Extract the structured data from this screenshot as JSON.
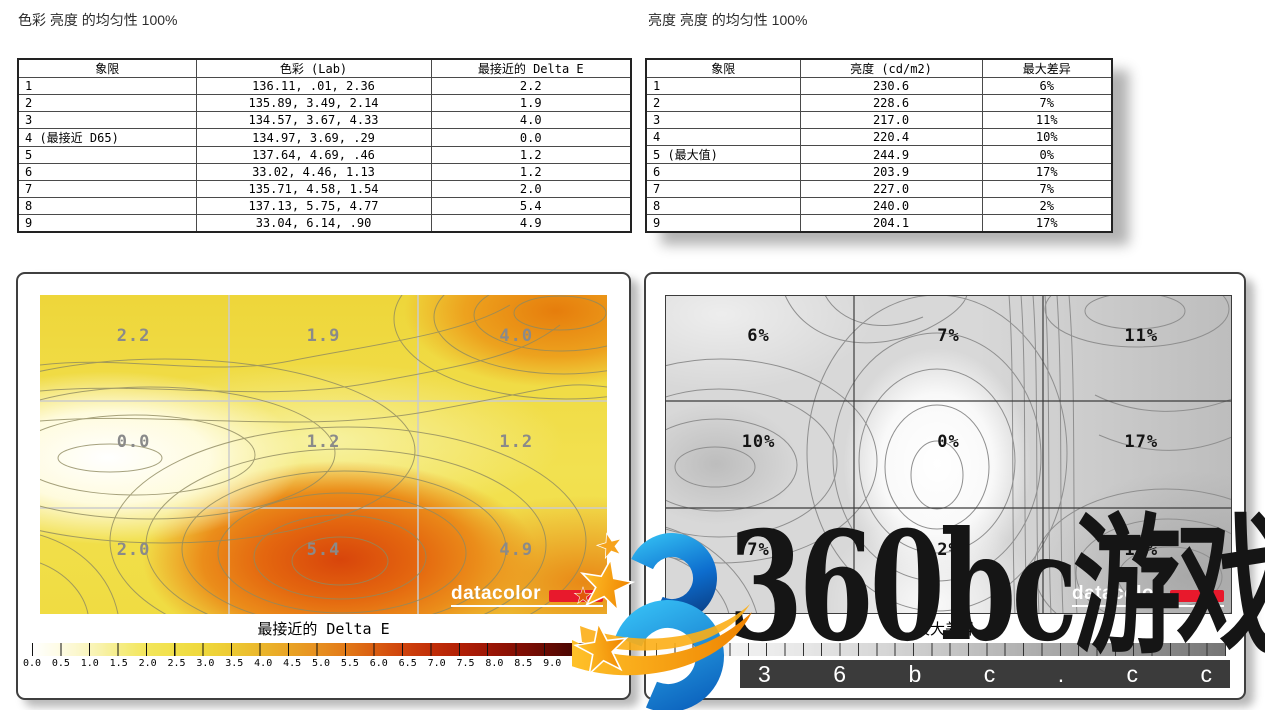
{
  "left_report": {
    "title": "色彩 亮度 的均匀性 100%",
    "table": {
      "headers": [
        "象限",
        "色彩 (Lab)",
        "最接近的 Delta E"
      ],
      "rows": [
        {
          "q": "1",
          "lab": "136.11,    .01,   2.36",
          "de": "2.2"
        },
        {
          "q": "2",
          "lab": "135.89,   3.49,   2.14",
          "de": "1.9"
        },
        {
          "q": "3",
          "lab": "134.57,   3.67,   4.33",
          "de": "4.0"
        },
        {
          "q": "4 (最接近 D65)",
          "lab": "134.97,   3.69,    .29",
          "de": "0.0"
        },
        {
          "q": "5",
          "lab": "137.64,   4.69,    .46",
          "de": "1.2"
        },
        {
          "q": "6",
          "lab": " 33.02,   4.46,   1.13",
          "de": "1.2"
        },
        {
          "q": "7",
          "lab": "135.71,   4.58,   1.54",
          "de": "2.0"
        },
        {
          "q": "8",
          "lab": "137.13,   5.75,   4.77",
          "de": "5.4"
        },
        {
          "q": "9",
          "lab": " 33.04,   6.14,    .90",
          "de": "4.9"
        }
      ]
    },
    "map": {
      "cells": [
        "2.2",
        "1.9",
        "4.0",
        "0.0",
        "1.2",
        "1.2",
        "2.0",
        "5.4",
        "4.9"
      ],
      "caption": "最接近的 Delta E",
      "ticks": [
        "0.0",
        "0.5",
        "1.0",
        "1.5",
        "2.0",
        "2.5",
        "3.0",
        "3.5",
        "4.0",
        "4.5",
        "5.0",
        "5.5",
        "6.0",
        "6.5",
        "7.0",
        "7.5",
        "8.0",
        "8.5",
        "9.0",
        "9.5",
        "10.0"
      ],
      "logo_text": "datacolor"
    }
  },
  "right_report": {
    "title": "亮度 亮度 的均匀性 100%",
    "table": {
      "headers": [
        "象限",
        "亮度 (cd/m2)",
        "最大差异"
      ],
      "rows": [
        {
          "q": "1",
          "lum": "230.6",
          "diff": "6%"
        },
        {
          "q": "2",
          "lum": "228.6",
          "diff": "7%"
        },
        {
          "q": "3",
          "lum": "217.0",
          "diff": "11%"
        },
        {
          "q": "4",
          "lum": "220.4",
          "diff": "10%"
        },
        {
          "q": "5 (最大值)",
          "lum": "244.9",
          "diff": "0%"
        },
        {
          "q": "6",
          "lum": "203.9",
          "diff": "17%"
        },
        {
          "q": "7",
          "lum": "227.0",
          "diff": "7%"
        },
        {
          "q": "8",
          "lum": "240.0",
          "diff": "2%"
        },
        {
          "q": "9",
          "lum": "204.1",
          "diff": "17%"
        }
      ]
    },
    "map": {
      "cells": [
        "6%",
        "7%",
        "11%",
        "10%",
        "0%",
        "17%",
        "7%",
        "2%",
        "17%"
      ],
      "caption": "最大差异",
      "visible_ticks": [
        "0",
        "3"
      ],
      "logo_text": "datacolor"
    }
  },
  "watermark": {
    "big_text": "360bc游戏",
    "bar_letters": [
      "3",
      "6",
      "b",
      "c",
      ".",
      "c",
      "c"
    ],
    "colors": {
      "blue": "#1e9be4",
      "orange": "#f6981c",
      "bar_bg": "#3b3b3b"
    }
  },
  "brand": {
    "datacolor_red": "#e8192c"
  },
  "chart_data": [
    {
      "type": "heatmap",
      "title": "色彩 亮度 的均匀性 100%",
      "layout": "3x3 quadrant contour map, quadrants numbered 1-9, grid on",
      "categories_columns": [
        "left",
        "center",
        "right"
      ],
      "categories_rows": [
        "top",
        "middle",
        "bottom"
      ],
      "values": [
        [
          2.2,
          1.9,
          4.0
        ],
        [
          0.0,
          1.2,
          1.2
        ],
        [
          2.0,
          5.4,
          4.9
        ]
      ],
      "series_note": "Delta E per quadrant; quadrant 4 closest to D65 (0.0), max 5.4 bottom-center",
      "colorbar": {
        "label": "最接近的 Delta E",
        "min": 0.0,
        "max": 10.0,
        "step": 0.5,
        "colors": [
          "#ffffff",
          "#f3e65c",
          "#e9a425",
          "#cf430c",
          "#9d1605",
          "#2d0402"
        ],
        "position": "bottom"
      }
    },
    {
      "type": "heatmap",
      "title": "亮度 亮度 的均匀性 100%",
      "layout": "3x3 quadrant contour map, grayscale, grid on",
      "categories_columns": [
        "left",
        "center",
        "right"
      ],
      "categories_rows": [
        "top",
        "middle",
        "bottom"
      ],
      "values": [
        [
          6,
          7,
          11
        ],
        [
          10,
          0,
          17
        ],
        [
          7,
          2,
          17
        ]
      ],
      "unit": "%",
      "series_note": "max luminance difference per quadrant; quadrant 5 is max luminance 244.9 cd/m2 (0%)",
      "colorbar": {
        "label": "最大差异",
        "visible_tick_labels": [
          0,
          3
        ],
        "colors": [
          "#ffffff",
          "#757575"
        ],
        "position": "bottom"
      }
    },
    {
      "type": "table",
      "title": "色彩 (Lab) per 象限",
      "columns": [
        "象限",
        "L",
        "a",
        "b",
        "最接近的 Delta E"
      ],
      "rows": [
        [
          "1",
          136.11,
          0.01,
          2.36,
          2.2
        ],
        [
          "2",
          135.89,
          3.49,
          2.14,
          1.9
        ],
        [
          "3",
          134.57,
          3.67,
          4.33,
          4.0
        ],
        [
          "4 (最接近 D65)",
          134.97,
          3.69,
          0.29,
          0.0
        ],
        [
          "5",
          137.64,
          4.69,
          0.46,
          1.2
        ],
        [
          "6",
          33.02,
          4.46,
          1.13,
          1.2
        ],
        [
          "7",
          135.71,
          4.58,
          1.54,
          2.0
        ],
        [
          "8",
          137.13,
          5.75,
          4.77,
          5.4
        ],
        [
          "9",
          33.04,
          6.14,
          0.9,
          4.9
        ]
      ]
    },
    {
      "type": "table",
      "title": "亮度 (cd/m2) per 象限",
      "columns": [
        "象限",
        "亮度 (cd/m2)",
        "最大差异"
      ],
      "rows": [
        [
          "1",
          230.6,
          "6%"
        ],
        [
          "2",
          228.6,
          "7%"
        ],
        [
          "3",
          217.0,
          "11%"
        ],
        [
          "4",
          220.4,
          "10%"
        ],
        [
          "5 (最大值)",
          244.9,
          "0%"
        ],
        [
          "6",
          203.9,
          "17%"
        ],
        [
          "7",
          227.0,
          "7%"
        ],
        [
          "8",
          240.0,
          "2%"
        ],
        [
          "9",
          204.1,
          "17%"
        ]
      ]
    }
  ]
}
